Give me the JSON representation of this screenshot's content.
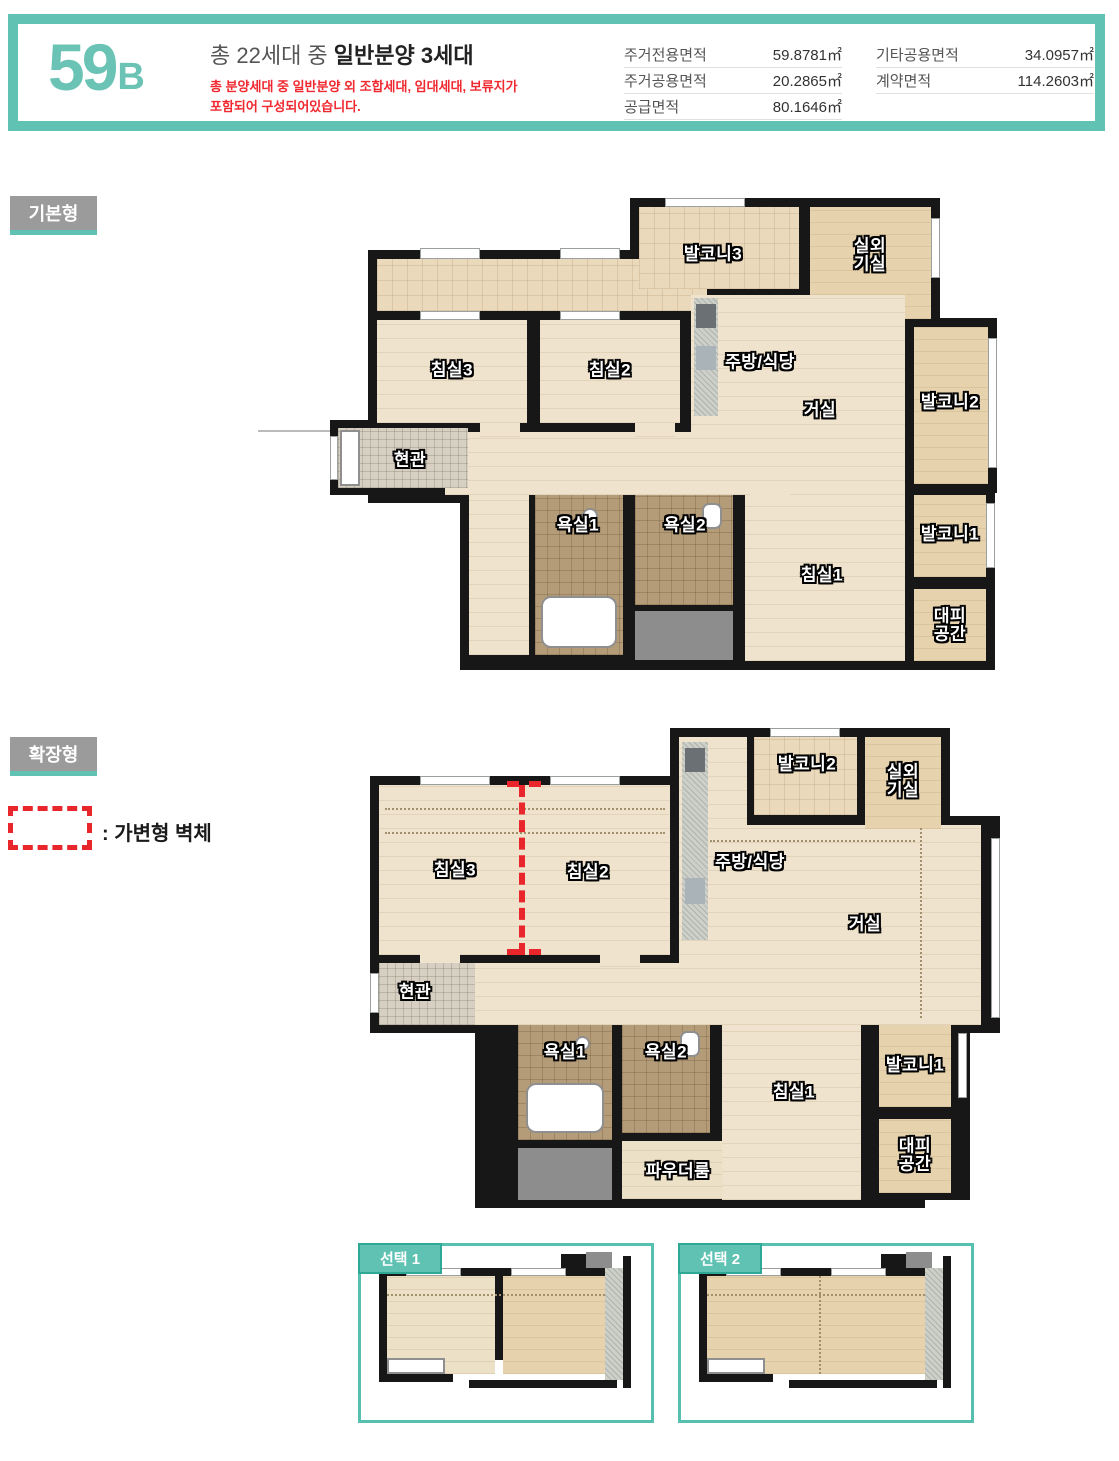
{
  "header": {
    "unit_code": {
      "number": "59",
      "suffix": "B"
    },
    "title": {
      "prefix": "총 22세대 중 ",
      "emphasis": "일반분양 3세대"
    },
    "notice_line1": "총 분양세대 중 일반분양 외 조합세대, 임대세대, 보류지가",
    "notice_line2": "포함되어 구성되어있습니다.",
    "area_table_left": [
      {
        "label": "주거전용면적",
        "value": "59.8781㎡"
      },
      {
        "label": "주거공용면적",
        "value": "20.2865㎡"
      },
      {
        "label": "공급면적",
        "value": "80.1646㎡"
      }
    ],
    "area_table_right": [
      {
        "label": "기타공용면적",
        "value": "34.0957㎡"
      },
      {
        "label": "계약면적",
        "value": "114.2603㎡"
      }
    ]
  },
  "sections": {
    "basic": {
      "badge": "기본형"
    },
    "extended": {
      "badge": "확장형",
      "legend": ": 가변형 벽체"
    }
  },
  "plan_basic": {
    "rooms": {
      "balcony3": "발코니3",
      "outdoor_unit": "실외기실",
      "bedroom3": "침실3",
      "bedroom2": "침실2",
      "kitchen_dining": "주방/식당",
      "living": "거실",
      "balcony2": "발코니2",
      "entrance": "현관",
      "bath1": "욕실1",
      "bath2": "욕실2",
      "bedroom1": "침실1",
      "balcony1": "발코니1",
      "refuge": "대피공간"
    }
  },
  "plan_extended": {
    "rooms": {
      "balcony2": "발코니2",
      "outdoor_unit": "실외기실",
      "bedroom3": "침실3",
      "bedroom2": "침실2",
      "kitchen_dining": "주방/식당",
      "living": "거실",
      "entrance": "현관",
      "bath1": "욕실1",
      "bath2": "욕실2",
      "bedroom1": "침실1",
      "powder_room": "파우더룸",
      "balcony1": "발코니1",
      "refuge": "대피공간"
    }
  },
  "options": [
    {
      "label": "선택 1"
    },
    {
      "label": "선택 2"
    }
  ],
  "colors": {
    "accent_teal": "#5fc2b2",
    "tab_teal_border": "#2fa896",
    "badge_gray": "#9b9b9b",
    "notice_red": "#f0282f",
    "variable_wall_red": "#e8262c",
    "wall_black": "#171717",
    "wood_floor": "#efe3cd",
    "balcony_tan": "#e6d3ae",
    "bath_tile": "#b49c78"
  }
}
